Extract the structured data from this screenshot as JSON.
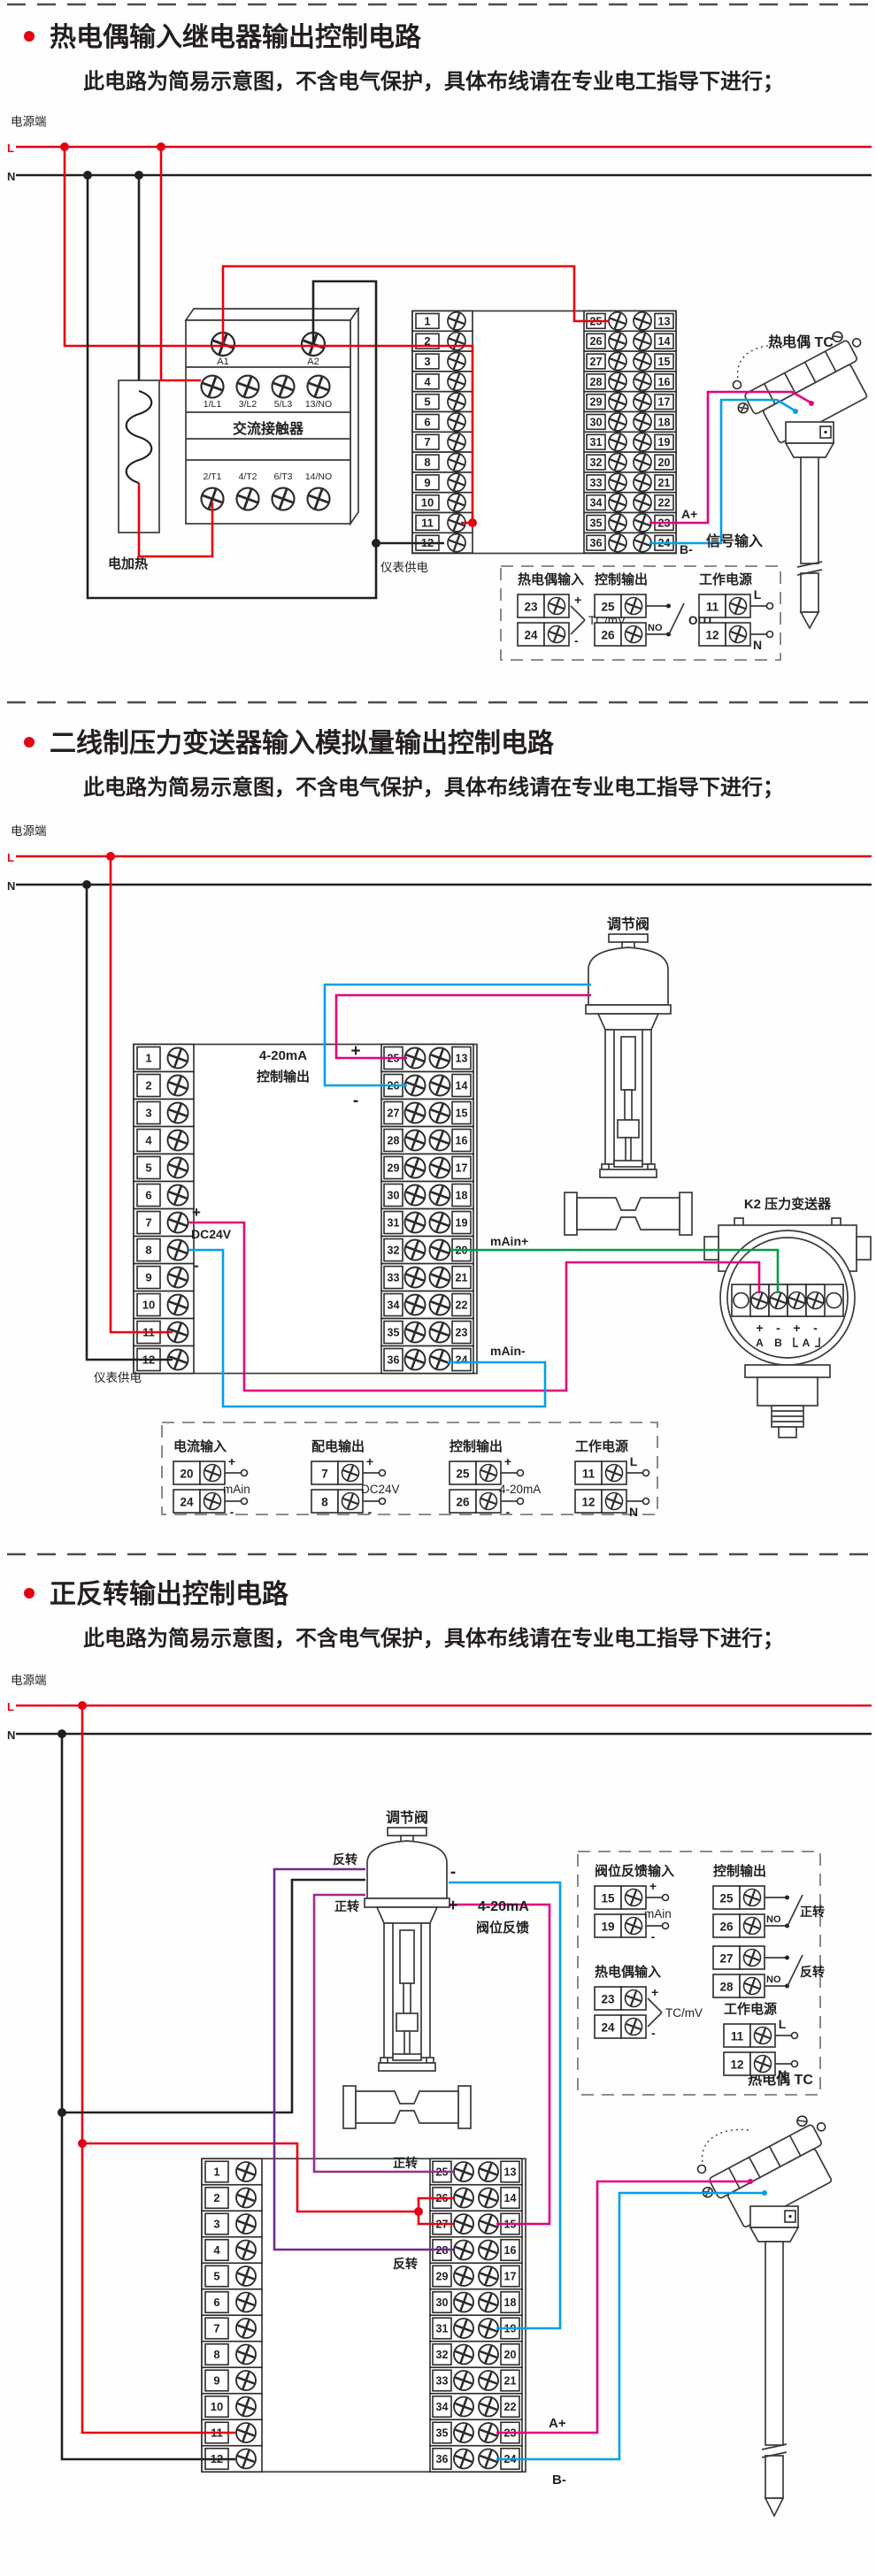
{
  "colors": {
    "live": "#e60012",
    "neutral": "#231f20",
    "magenta": "#e4007f",
    "blue": "#00a0e9",
    "green": "#009a49",
    "reverse_purple": "#6f2c91",
    "forward_purple": "#9c2b91"
  },
  "terminals": {
    "left": [
      "1",
      "2",
      "3",
      "4",
      "5",
      "6",
      "7",
      "8",
      "9",
      "10",
      "11",
      "12"
    ],
    "mid": [
      "25",
      "26",
      "27",
      "28",
      "29",
      "30",
      "31",
      "32",
      "33",
      "34",
      "35",
      "36"
    ],
    "right": [
      "13",
      "14",
      "15",
      "16",
      "17",
      "18",
      "19",
      "20",
      "21",
      "22",
      "23",
      "24"
    ]
  },
  "sections": [
    {
      "title": "热电偶输入继电器输出控制电路",
      "subtitle": "此电路为简易示意图，不含电气保护，具体布线请在专业电工指导下进行；",
      "power_label": "电源端",
      "l": "L",
      "n": "N",
      "contactor": {
        "a1": "A1",
        "a2": "A2",
        "name": "交流接触器",
        "row_top": [
          "1/L1",
          "3/L2",
          "5/L3",
          "13/NO"
        ],
        "row_bottom": [
          "2/T1",
          "4/T2",
          "6/T3",
          "14/NO"
        ]
      },
      "heater": "电加热",
      "meter_supply": "仪表供电",
      "signal_input": "信号输入",
      "tc_title": "热电偶 TC",
      "a_plus": "A+",
      "b_minus": "B-",
      "legend": [
        {
          "title": "热电偶输入",
          "rows": [
            [
              "23",
              "+"
            ],
            [
              "24",
              "-"
            ]
          ],
          "tag": "TC/mV",
          "style": "brace"
        },
        {
          "title": "控制输出",
          "rows": [
            [
              "25",
              ""
            ],
            [
              "26",
              ""
            ]
          ],
          "no": "NO",
          "tag": "OUT",
          "style": "switch"
        },
        {
          "title": "工作电源",
          "rows": [
            [
              "11",
              "L"
            ],
            [
              "12",
              "N"
            ]
          ],
          "tag": "",
          "style": "circles"
        }
      ]
    },
    {
      "title": "二线制压力变送器输入模拟量输出控制电路",
      "subtitle": "此电路为简易示意图，不含电气保护，具体布线请在专业电工指导下进行；",
      "power_label": "电源端",
      "l": "L",
      "n": "N",
      "valve": "调节阀",
      "out1": "4-20mA",
      "out2": "控制输出",
      "plus": "+",
      "minus": "-",
      "dc_label": "DC24V",
      "main_plus": "mAin+",
      "main_minus": "mAin-",
      "meter_supply": "仪表供电",
      "transmitter": "K2  压力变送器",
      "tx_signs": [
        "+",
        "-",
        "+",
        "-"
      ],
      "tx_letters": [
        "A",
        "B",
        "A"
      ],
      "legend": [
        {
          "title": "电流输入",
          "rows": [
            [
              "20",
              "+"
            ],
            [
              "24",
              "-"
            ]
          ],
          "tag": "mAin",
          "style": "circles"
        },
        {
          "title": "配电输出",
          "rows": [
            [
              "7",
              "+"
            ],
            [
              "8",
              "-"
            ]
          ],
          "tag": "DC24V",
          "style": "circles"
        },
        {
          "title": "控制输出",
          "rows": [
            [
              "25",
              "+"
            ],
            [
              "26",
              "-"
            ]
          ],
          "tag": "4-20mA",
          "style": "circles"
        },
        {
          "title": "工作电源",
          "rows": [
            [
              "11",
              "L"
            ],
            [
              "12",
              "N"
            ]
          ],
          "tag": "",
          "style": "circles"
        }
      ]
    },
    {
      "title": "正反转输出控制电路",
      "subtitle": "此电路为简易示意图，不含电气保护，具体布线请在专业电工指导下进行；",
      "power_label": "电源端",
      "l": "L",
      "n": "N",
      "valve": "调节阀",
      "forward": "正转",
      "reverse": "反转",
      "plus": "+",
      "minus": "-",
      "fb1": "4-20mA",
      "fb2": "阀位反馈",
      "a_plus": "A+",
      "b_minus": "B-",
      "tc_title": "热电偶 TC",
      "legend": [
        {
          "title": "阀位反馈输入",
          "rows": [
            [
              "15",
              "+"
            ],
            [
              "19",
              "-"
            ]
          ],
          "tag": "mAin",
          "style": "circles"
        },
        {
          "title": "热电偶输入",
          "rows": [
            [
              "23",
              "+"
            ],
            [
              "24",
              "-"
            ]
          ],
          "tag": "TC/mV",
          "style": "brace"
        },
        {
          "title": "控制输出",
          "rows": [
            [
              "25",
              ""
            ],
            [
              "26",
              ""
            ]
          ],
          "no": "NO",
          "tag": "正转",
          "style": "switch2"
        },
        {
          "title": "",
          "rows": [
            [
              "27",
              ""
            ],
            [
              "28",
              ""
            ]
          ],
          "no": "NO",
          "tag": "反转",
          "style": "switch2"
        },
        {
          "title": "工作电源",
          "rows": [
            [
              "11",
              "L"
            ],
            [
              "12",
              "N"
            ]
          ],
          "tag": "",
          "style": "circles"
        }
      ]
    }
  ]
}
